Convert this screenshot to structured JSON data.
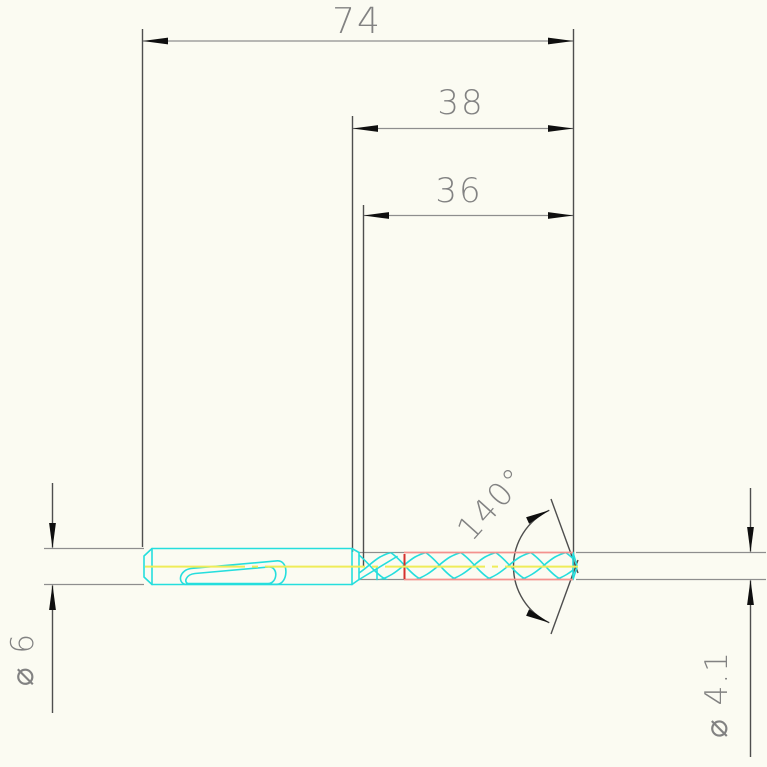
{
  "drawing": {
    "title": "drill-bit-technical-drawing",
    "view": "side-view",
    "labels": {
      "overall_length": "74",
      "shank_to_tip_length": "38",
      "flute_length": "36",
      "point_angle": "140°",
      "shank_diameter": "⌀ 6",
      "cutting_diameter": "⌀ 4.1"
    },
    "values": {
      "overall_length_mm": 74,
      "shank_to_tip_length_mm": 38,
      "flute_length_mm": 36,
      "point_angle_deg": 140,
      "shank_diameter_mm": 6,
      "cutting_diameter_mm": 4.1
    },
    "colors": {
      "background": "#fbfbf2",
      "outline_cyan": "#25dedd",
      "flute_edge_pink": "#f4918e",
      "mark_red": "#d4312e",
      "centerline_yellow": "#efec58",
      "dimension_light_gray": "#8e8e8e",
      "dimension_dark_gray": "#4e4e4e",
      "arrow_black": "#0f0f0f",
      "text_gray": "#828282"
    }
  }
}
